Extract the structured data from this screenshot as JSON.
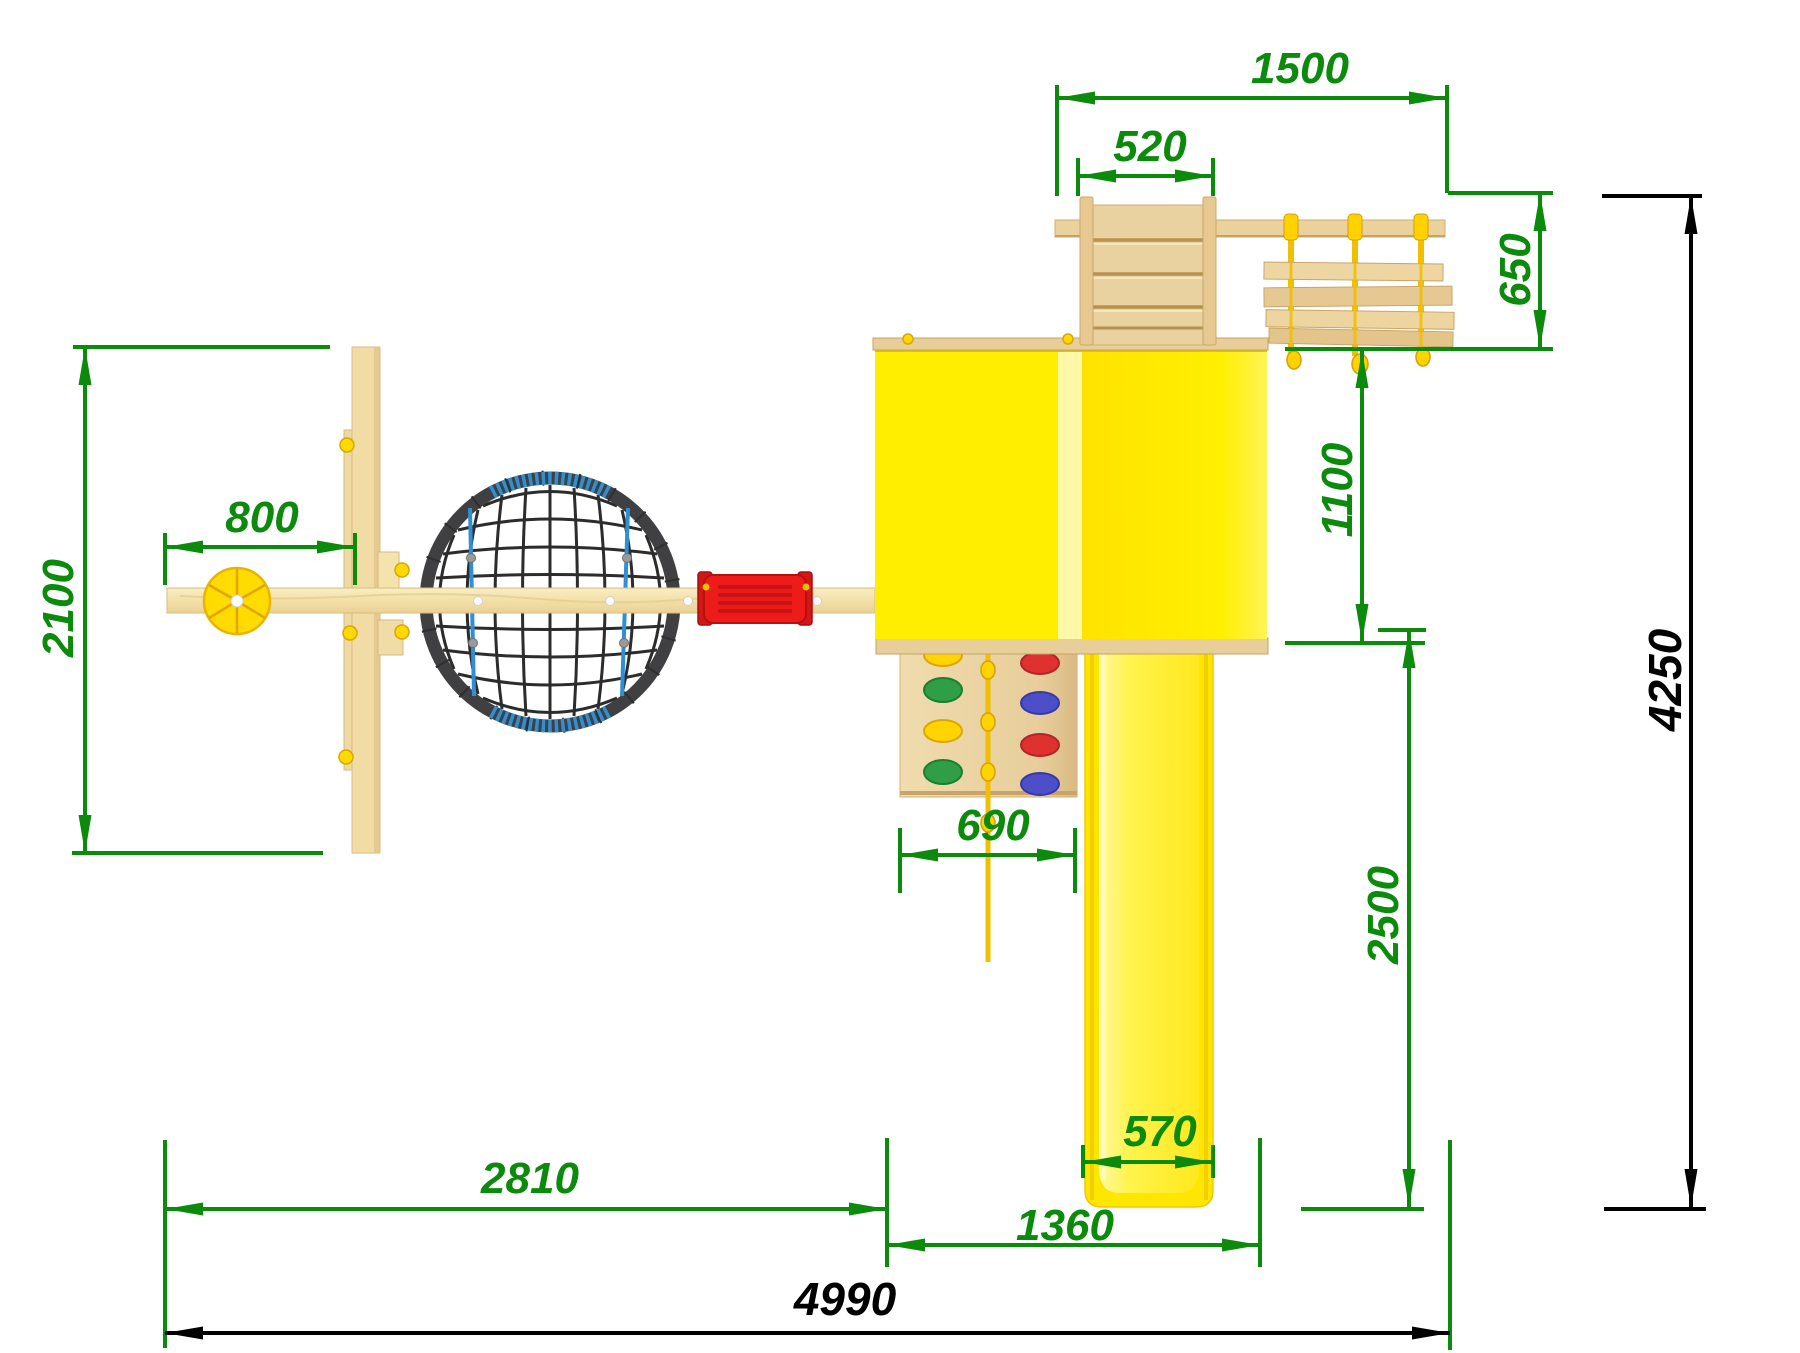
{
  "drawing": {
    "units": "mm",
    "view": "top-view playground set dimensional drawing",
    "colors": {
      "dimension_green": "#0c8a0c",
      "dimension_black": "#000000",
      "wood_light": "#f2dca6",
      "wood_deck": "#e8ce99",
      "roof_yellow": "#ffee00",
      "slide_yellow": "#ffe600",
      "swing_seat_red": "#ee1b1b",
      "nest_rim_gray": "#404043",
      "rope_blue": "#2f8fd2",
      "rope_yellow": "#f2bf00"
    },
    "dimensions": {
      "top_module_width": {
        "value": "1500"
      },
      "ramp_width": {
        "value": "520"
      },
      "ladder_depth": {
        "value": "650"
      },
      "deck_depth": {
        "value": "1100"
      },
      "overall_depth": {
        "value": "4250"
      },
      "swing_frame_length": {
        "value": "2100"
      },
      "wheel_offset": {
        "value": "800"
      },
      "climb_wall_width": {
        "value": "690"
      },
      "slide_run": {
        "value": "2500"
      },
      "slide_width": {
        "value": "570"
      },
      "swing_section_width": {
        "value": "2810"
      },
      "tower_section_width": {
        "value": "1360"
      },
      "overall_width": {
        "value": "4990"
      }
    }
  }
}
